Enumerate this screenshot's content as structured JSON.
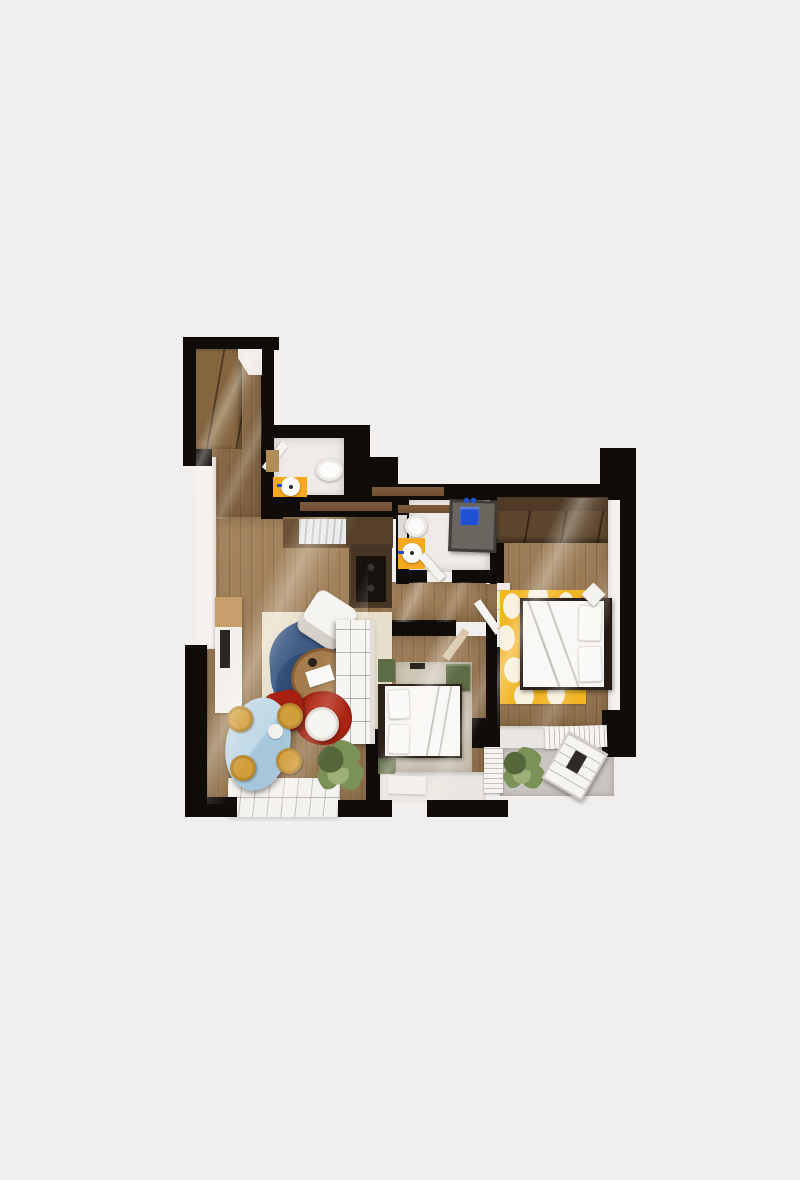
{
  "scene": {
    "type": "apartment-floor-plan-3d-top-view",
    "description": "Rendered top-down 3D floor plan of a two-bedroom apartment with living room, kitchen, two bathrooms, two bedrooms and balconies, on a plain light background. No text labels are rendered.",
    "canvas": {
      "width": 800,
      "height": 1180
    }
  },
  "palette": {
    "background": "#f1efed",
    "wall": "#0f0c0a",
    "wall_cap": "#6f4f32",
    "wood_hall": "#8a6a46",
    "wood_living": "#a07e55",
    "wood_bed1": "#977650",
    "wood_bed2": "#9a7951",
    "white_floor": "#efece8",
    "white_wall": "#f4f1ef",
    "orange": "#f6a81e",
    "counter_brown": "#6b5135",
    "counter_dark": "#55412b",
    "cabinet_dark": "#473525",
    "cooktop": "#17120e",
    "wardrobe_hall": "#83653f",
    "wardrobe_master": "#5c462e",
    "wood_top": "#c79f6b",
    "rug_cream": "#e7dfcc",
    "rug_blue": "#3e5c86",
    "rug_blue_dark": "#2d4a74",
    "rug_yellow": "#f2b525",
    "rug_beige": "#cdc6b7",
    "green_accent": "#5d6c46",
    "red_chair": "#a61f10",
    "red_rug": "#b02513",
    "table_blue": "#a6c6dc",
    "table_blue_light": "#c2d9e8",
    "stool_yellow": "#d19e3c",
    "balcony_gray": "#c9c5c1",
    "furniture_white": "#f5f4f1",
    "plant_green": "#7a9158",
    "plant_green_dark": "#55683c",
    "plant_green_light": "#9db077",
    "shower_dark": "#413c38",
    "shower_blue": "#1e50d2",
    "bed_frame": "#2c221a"
  },
  "rooms": [
    {
      "id": "entry-hall",
      "floor": "wood",
      "furniture": [
        "built-in-wardrobe"
      ]
    },
    {
      "id": "guest-wc",
      "floor": "white-tile",
      "furniture": [
        "toilet",
        "orange-vanity-with-round-sink",
        "door-leaf",
        "wood-shelf"
      ]
    },
    {
      "id": "kitchen",
      "floor": "wood",
      "furniture": [
        "counter-with-sink",
        "tall-dark-cabinet",
        "black-cooktop"
      ]
    },
    {
      "id": "living-room",
      "floor": "wood",
      "furniture": [
        "tv-console",
        "blue-abstract-rug",
        "white-armchair",
        "oval-wood-coffee-table",
        "white-tufted-sofa",
        "red-armchair",
        "red-round-rug",
        "white-side-chair",
        "blue-oval-dining-table",
        "four-yellow-stools",
        "plant"
      ]
    },
    {
      "id": "bathroom",
      "floor": "white-tile",
      "furniture": [
        "toilet",
        "dark-shower-cabin-with-blue-fixture",
        "orange-mat-with-round-sink",
        "door-leaf"
      ]
    },
    {
      "id": "bedroom-center",
      "floor": "wood",
      "furniture": [
        "beige-rug",
        "double-bed-white",
        "green-bench",
        "green-cushions",
        "white-mat",
        "door-leaf"
      ]
    },
    {
      "id": "bedroom-master",
      "floor": "wood",
      "furniture": [
        "dark-wardrobe",
        "yellow-spotted-rug",
        "double-bed-white",
        "rotated-nightstand",
        "door-leaf"
      ]
    },
    {
      "id": "living-terrace",
      "floor": "white-deck-slats",
      "furniture": []
    },
    {
      "id": "master-balcony",
      "floor": "gray-concrete",
      "furniture": [
        "plant",
        "white-lounge-chair",
        "railings"
      ]
    }
  ]
}
